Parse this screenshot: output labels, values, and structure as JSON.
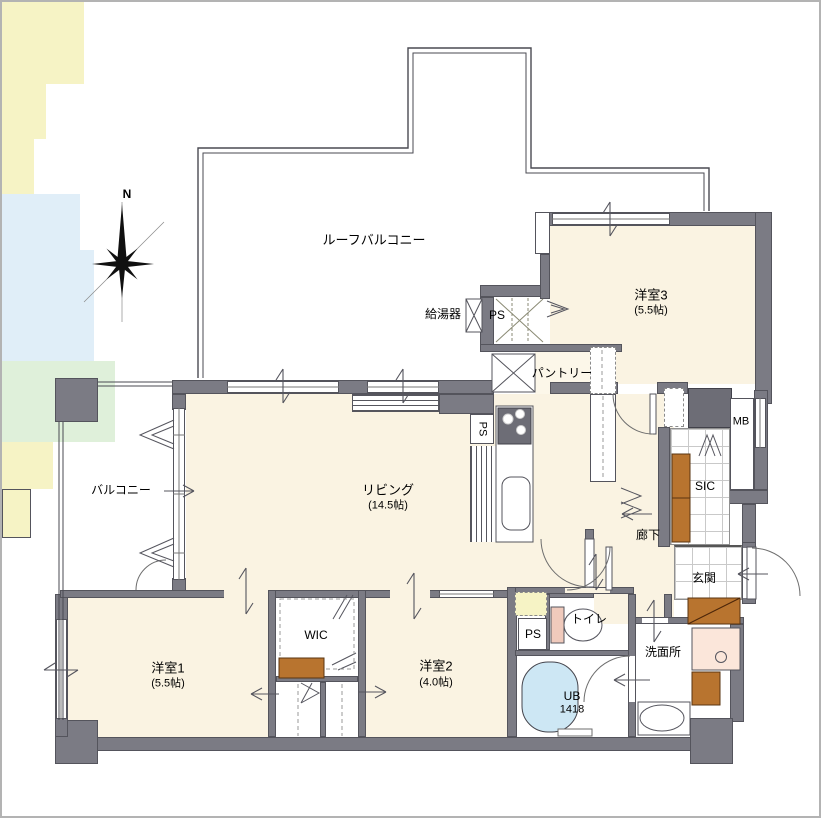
{
  "compass": {
    "label": "N"
  },
  "colors": {
    "wall_gray": "#7b7b84",
    "duct_gray": "#6d6d76",
    "floor_cream": "#faf3e2",
    "closet_yellow": "#f6f3c5",
    "bath_green": "#dff0da",
    "wet_area_blue": "#e0eef8",
    "tub_blue": "#cde7f4",
    "furniture_brown": "#b8742f",
    "vanity_pink": "#fbe6da",
    "toilet_tank_pink": "#f0cabc"
  },
  "labels": {
    "roof_balcony": "ルーフバルコニー",
    "water_heater": "給湯器",
    "ps_top": "PS",
    "bedroom3": "洋室3",
    "bedroom3_size": "(5.5帖)",
    "pantry": "パントリー",
    "mb": "MB",
    "living": "リビング",
    "living_size": "(14.5帖)",
    "ps_kitchen": "PS",
    "balcony": "バルコニー",
    "sic": "SIC",
    "hallway": "廊下",
    "genkan": "玄関",
    "wic": "WIC",
    "bedroom1": "洋室1",
    "bedroom1_size": "(5.5帖)",
    "bedroom2": "洋室2",
    "bedroom2_size": "(4.0帖)",
    "ps_toilet": "PS",
    "toilet": "トイレ",
    "washroom": "洗面所",
    "bath": "UB",
    "bath_size": "1418"
  }
}
